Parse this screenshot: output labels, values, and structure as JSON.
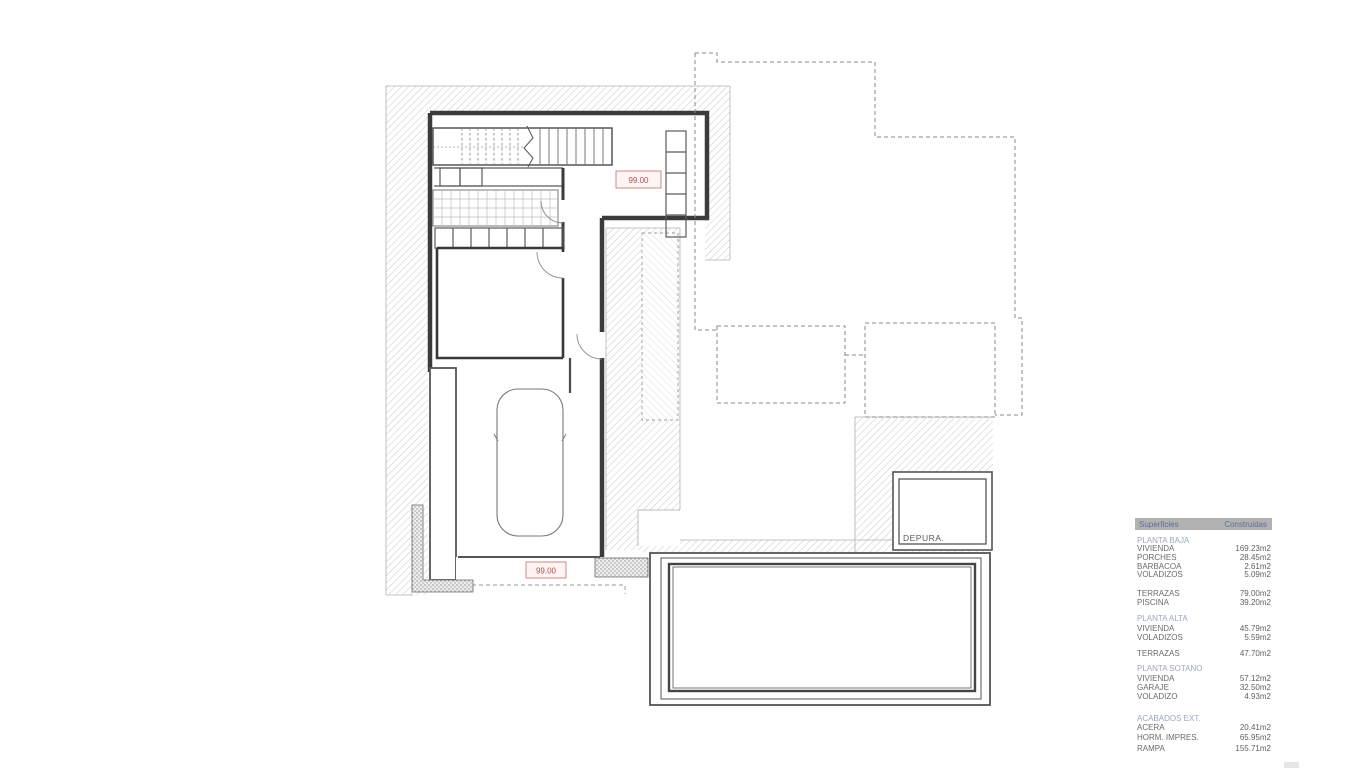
{
  "plan": {
    "labels": {
      "level_hall": "99.00",
      "level_drive": "99.00",
      "depura": "DEPURA."
    }
  },
  "legend": {
    "columns": {
      "c1": "Superficies",
      "c2": "Construidas"
    },
    "rows": [
      {
        "type": "section",
        "label": "PLANTA BAJA"
      },
      {
        "type": "item",
        "label": "VIVIENDA",
        "value": "169.23m2"
      },
      {
        "type": "item",
        "label": "PORCHES",
        "value": "28.45m2"
      },
      {
        "type": "item",
        "label": "BARBACOA",
        "value": "2.61m2"
      },
      {
        "type": "item",
        "label": "VOLADIZOS",
        "value": "5.09m2"
      },
      {
        "type": "item",
        "label": "TERRAZAS",
        "value": "79.00m2"
      },
      {
        "type": "item",
        "label": "PISCINA",
        "value": "39.20m2"
      },
      {
        "type": "section",
        "label": "PLANTA ALTA"
      },
      {
        "type": "item",
        "label": "VIVIENDA",
        "value": "45.79m2"
      },
      {
        "type": "item",
        "label": "VOLADIZOS",
        "value": "5.59m2"
      },
      {
        "type": "item",
        "label": "TERRAZAS",
        "value": "47.70m2"
      },
      {
        "type": "section",
        "label": "PLANTA SOTANO"
      },
      {
        "type": "item",
        "label": "VIVIENDA",
        "value": "57.12m2"
      },
      {
        "type": "item",
        "label": "GARAJE",
        "value": "32.50m2"
      },
      {
        "type": "item",
        "label": "VOLADIZO",
        "value": "4.93m2"
      },
      {
        "type": "section",
        "label": "ACABADOS EXT."
      },
      {
        "type": "item",
        "label": "ACERA",
        "value": "20.41m2"
      },
      {
        "type": "item",
        "label": "HORM. IMPRES.",
        "value": "65.95m2"
      },
      {
        "type": "item",
        "label": "RAMPA",
        "value": "155.71m2"
      }
    ]
  },
  "colors": {
    "wall": "#3b3b3b",
    "accent_red": "#b05050",
    "legend_header_bg": "#b2b2b2",
    "legend_header_text": "#5e6f93",
    "section_text": "#9aa9bd"
  }
}
